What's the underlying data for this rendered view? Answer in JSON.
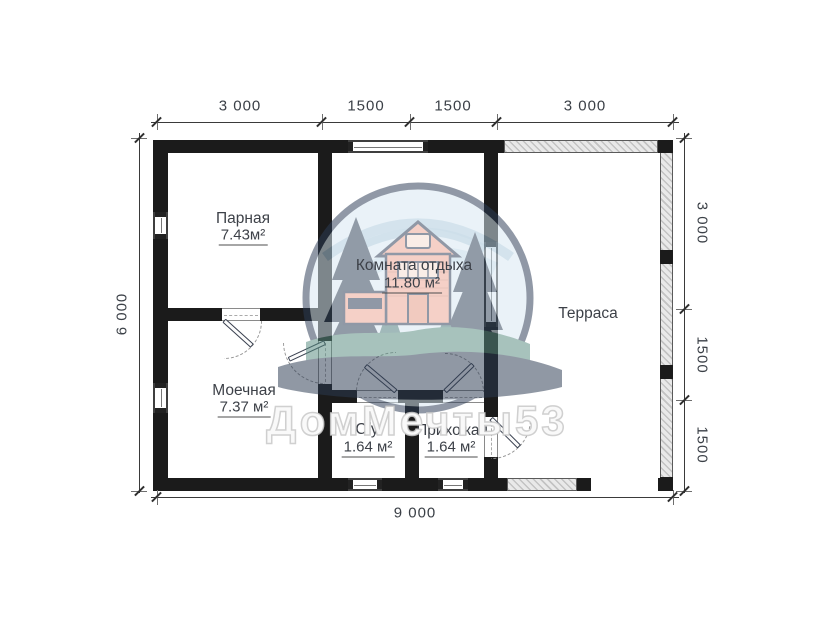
{
  "plan": {
    "watermark_text": "ДомМечты53",
    "rooms": {
      "parnaya": {
        "name": "Парная",
        "area": "7.43м²"
      },
      "komnata_otdyha": {
        "name": "Комната отдыха",
        "area": "11.80 м²"
      },
      "moechnaya": {
        "name": "Моечная",
        "area": "7.37 м²"
      },
      "su": {
        "name": "С/у",
        "area": "1.64 м²"
      },
      "prihozhaya": {
        "name": "Прихожая",
        "area": "1.64 м²"
      },
      "terrasa": {
        "name": "Терраса"
      }
    },
    "dimensions": {
      "top": [
        "3 000",
        "1500",
        "1500",
        "3 000"
      ],
      "bottom": "9 000",
      "left": "6 000",
      "right": [
        "3 000",
        "1500",
        "1500"
      ]
    },
    "colors": {
      "wall": "#1b1b1b",
      "terrace_hatch": "#dedede",
      "label_text": "#3d4148",
      "logo_navy": "#2c3c55",
      "logo_sky_blue": "#d8e8f2",
      "logo_house_salmon": "#eca795",
      "logo_green": "#578b80"
    }
  }
}
